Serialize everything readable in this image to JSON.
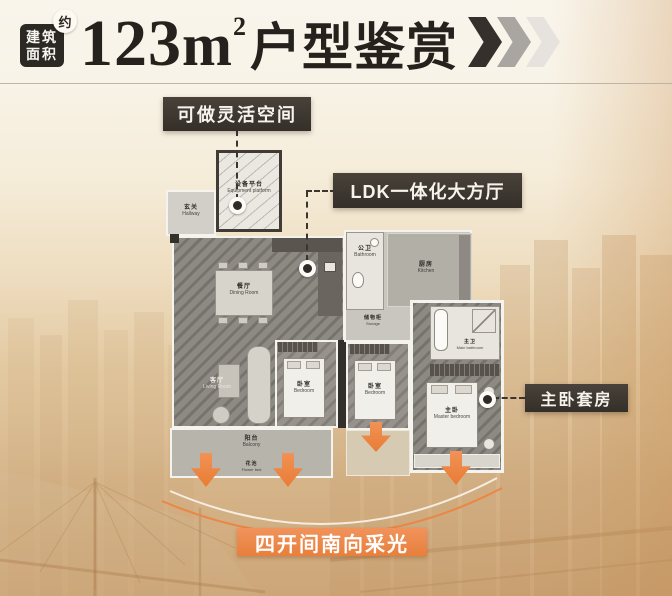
{
  "header": {
    "badge": {
      "line1": "建筑",
      "line2": "面积",
      "approx": "约"
    },
    "title": {
      "number": "123",
      "unit": "m",
      "sup": "2",
      "text": "户型鉴赏"
    }
  },
  "callouts": {
    "flexible_space": "可做灵活空间",
    "ldk": "LDK一体化大方厅",
    "master_suite": "主卧套房",
    "banner": "四开间南向采光"
  },
  "plan": {
    "rooms": {
      "equipment": {
        "cn": "设备平台",
        "en": "Equipment platform"
      },
      "hallway": {
        "cn": "玄关",
        "en": "Hallway"
      },
      "dining": {
        "cn": "餐厅",
        "en": "Dining Room"
      },
      "living": {
        "cn": "客厅",
        "en": "Living Room"
      },
      "balcony": {
        "cn": "阳台",
        "en": "Balcony"
      },
      "flower_bed": {
        "cn": "花池",
        "en": "Flower bed"
      },
      "bedroom_a": {
        "cn": "卧室",
        "en": "Bedroom"
      },
      "bedroom_b": {
        "cn": "卧室",
        "en": "Bedroom"
      },
      "bathroom": {
        "cn": "公卫",
        "en": "Bathroom"
      },
      "kitchen": {
        "cn": "厨房",
        "en": "Kitchen"
      },
      "storage": {
        "cn": "储物柜",
        "en": "Storage"
      },
      "master_bathroom": {
        "cn": "主卫",
        "en": "Main bathroom"
      },
      "master_bedroom": {
        "cn": "主卧",
        "en": "Master bedroom"
      }
    }
  },
  "colors": {
    "accent_orange": "#ec8443",
    "callout_dark": "#3c362f",
    "title_dark": "#25211d",
    "chevrons": [
      "#35302c",
      "#a9a6a2",
      "#e6e3df"
    ]
  }
}
